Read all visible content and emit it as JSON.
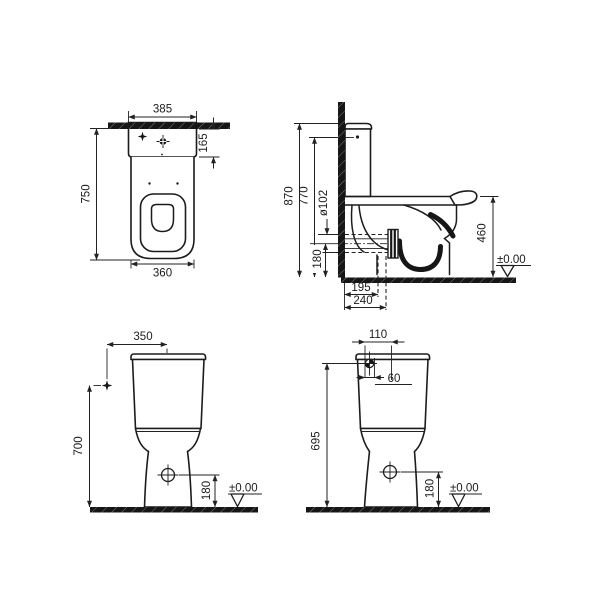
{
  "v1": {
    "width_top": "385",
    "tank_height": "165",
    "height": "750",
    "base_width": "360"
  },
  "v2": {
    "height_total": "870",
    "height_lid": "770",
    "outlet_dia": "ø102",
    "rim_height": "460",
    "outlet_center": "180",
    "outlet_proj": "195",
    "outlet_end": "240",
    "datum": "±0.00"
  },
  "v3": {
    "supply_offset": "350",
    "supply_height": "700",
    "drain_height": "180",
    "datum": "±0.00"
  },
  "v4": {
    "inlet_span": "110",
    "inlet_offset": "60",
    "height": "695",
    "drain_height": "180",
    "datum": "±0.00"
  }
}
